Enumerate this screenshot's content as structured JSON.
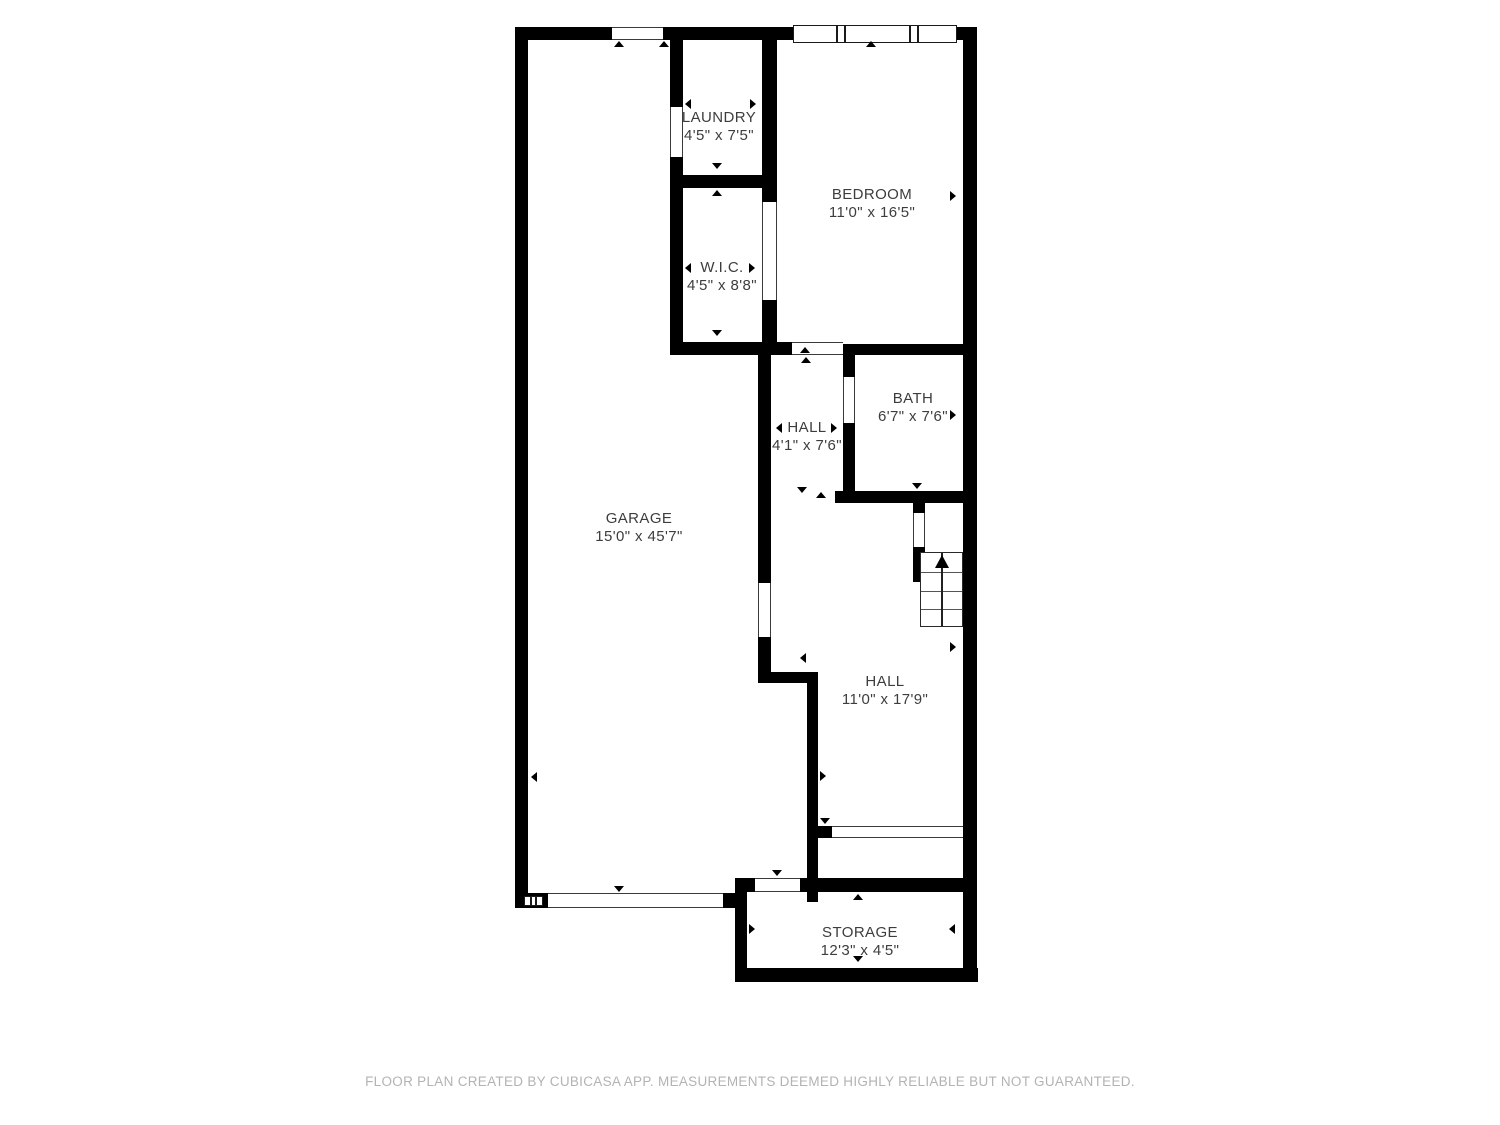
{
  "colors": {
    "wall": "#000000",
    "label_text": "#3d3d3d",
    "footer_text": "#b3b3b3",
    "background": "#ffffff"
  },
  "rooms": {
    "laundry": {
      "name": "LAUNDRY",
      "dims": "4'5\" x 7'5\""
    },
    "bedroom": {
      "name": "BEDROOM",
      "dims": "11'0\" x 16'5\""
    },
    "wic": {
      "name": "W.I.C.",
      "dims": "4'5\" x 8'8\""
    },
    "hall_upper": {
      "name": "HALL",
      "dims": "4'1\" x 7'6\""
    },
    "bath": {
      "name": "BATH",
      "dims": "6'7\" x 7'6\""
    },
    "garage": {
      "name": "GARAGE",
      "dims": "15'0\" x 45'7\""
    },
    "hall_lower": {
      "name": "HALL",
      "dims": "11'0\" x 17'9\""
    },
    "storage": {
      "name": "STORAGE",
      "dims": "12'3\" x 4'5\""
    }
  },
  "icons": {
    "stairs_direction": "up-arrow"
  },
  "footer": {
    "text": "FLOOR PLAN CREATED BY CUBICASA APP. MEASUREMENTS DEEMED HIGHLY RELIABLE BUT NOT GUARANTEED."
  }
}
